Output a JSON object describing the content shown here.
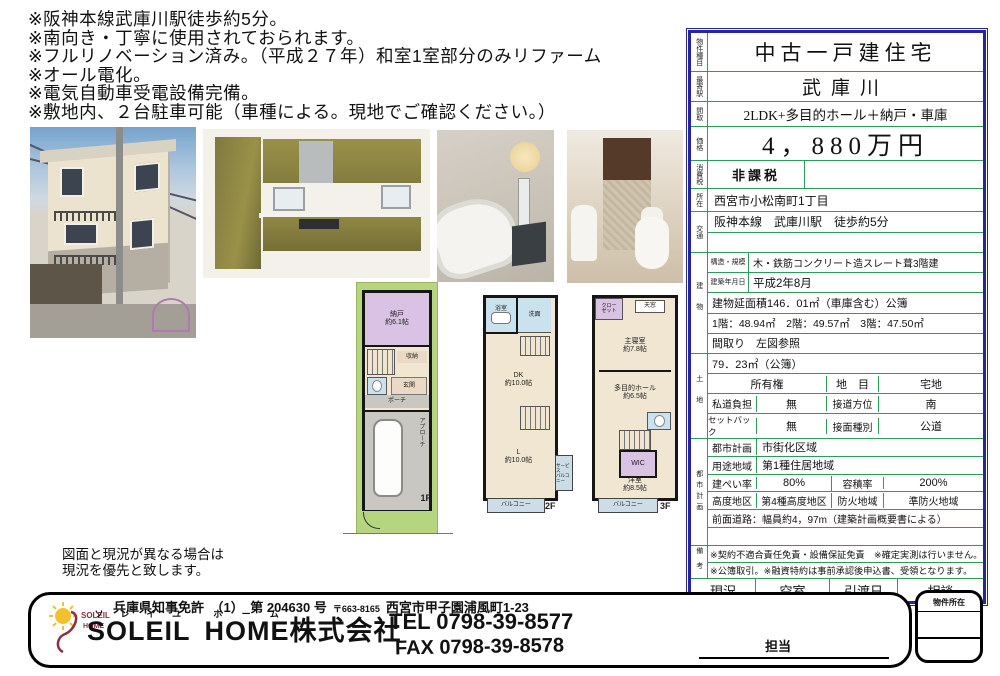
{
  "notes": {
    "lines": [
      "※阪神本線武庫川駅徒歩約5分。",
      "※南向き・丁寧に使用されておられます。",
      "※フルリノベーション済み。（平成２７年）和室1室部分のみリファーム",
      "※オール電化。",
      "※電気自動車受電設備完備。",
      "※敷地内、２台駐車可能（車種による。現地でご確認ください。）"
    ]
  },
  "disclaimer": {
    "line1": "図面と現況が異なる場合は",
    "line2": "現況を優先と致します。"
  },
  "table": {
    "property_type_label": "物件種目",
    "property_type": "中古一戸建住宅",
    "station_label": "最寄駅",
    "station": "武庫川",
    "layout_label": "間取",
    "layout": "2LDK+多目的ホール＋納戸・車庫",
    "price_label": "価格",
    "price": "4，880万円",
    "tax_label": "消費税",
    "tax": "非課税",
    "location_label": "所在",
    "location": "西宮市小松南町1丁目",
    "access_label": "交通",
    "access": "阪神本線　武庫川駅　徒歩約5分",
    "building": {
      "section_label": "建物",
      "structure_label": "構造・規模",
      "structure": "木・鉄筋コンクリート造スレート葺3階建",
      "built_label": "建築年月日",
      "built": "平成2年8月",
      "total_area": "建物延面積146．01㎡（車庫含む）公簿",
      "floor_areas": "1階：48.94㎡　2階：49.57㎡　3階：47.50㎡",
      "madori": "間取り　左図参照"
    },
    "land": {
      "section_label": "土地",
      "area": "79．23㎡（公簿）",
      "ownership": "所有権",
      "chimoku_label": "地　目",
      "chimoku": "宅地",
      "private_road_label": "私道負担",
      "private_road": "無",
      "direction_label": "接道方位",
      "direction": "南",
      "setback_label": "セットバック",
      "setback": "無",
      "road_type_label": "接面種別",
      "road_type": "公道"
    },
    "city": {
      "section_label": "都市計画",
      "plan_label": "都市計画",
      "plan": "市街化区域",
      "zoning_label": "用途地域",
      "zoning": "第1種住居地域",
      "coverage_label": "建ぺい率",
      "coverage": "80%",
      "far_label": "容積率",
      "far": "200%",
      "height_label": "高度地区",
      "height": "第4種高度地区",
      "fire_label": "防火地域",
      "fire": "準防火地域",
      "front_road": "前面道路：幅員約4，97m（建築計画概要書による）"
    },
    "remarks": {
      "section_label": "備考",
      "line1": "※契約不適合責任免責・設備保証免責　※確定実測は行いません。",
      "line2": "※公簿取引。※融資特約は事前承認後申込書、受領となります。"
    },
    "status_label": "現況",
    "status": "空室",
    "handover_label": "引渡日",
    "handover": "相談"
  },
  "floorplans": {
    "f1": {
      "nando1": "納戸",
      "nando2": "約6.1帖",
      "shuno": "収納",
      "genkan": "玄関",
      "porch": "ポーチ",
      "approach": "アプローチ",
      "floor": "1F"
    },
    "f2": {
      "bath": "浴室",
      "wash": "洗面",
      "dk1": "DK",
      "dk2": "約10.0帖",
      "l1": "L",
      "l2": "約10.0帖",
      "svc1": "サービス",
      "svc2": "バルコニー",
      "balcony": "バルコニー",
      "floor": "2F"
    },
    "f3": {
      "closet1": "クロー",
      "closet2": "ゼット",
      "tenmado": "天窓",
      "master1": "主寝室",
      "master2": "約7.8帖",
      "hall1": "多目的ホール",
      "hall2": "約6.5帖",
      "wic": "WIC",
      "yoshitsu1": "洋室",
      "yoshitsu2": "約8.5帖",
      "balcony": "バルコニー",
      "floor": "3F"
    }
  },
  "footer": {
    "license": "兵庫県知事免許　（1）　第 204630 号",
    "postal": "〒663-8165",
    "address": "西宮市甲子園浦風町1-23",
    "company_en1": "SOLEIL",
    "company_ruby1": "ソレイユ",
    "company_en2": "HOME",
    "company_ruby2": "ホーム",
    "company_suffix": "株式会社",
    "tel": "TEL 0798-39-8577",
    "fax": "FAX 0798-39-8578",
    "tanto": "担当",
    "logo_line1": "SOLEIL",
    "logo_line2": "HOME"
  },
  "side_box": {
    "title": "物件所在"
  },
  "colors": {
    "table_border": "#26269a",
    "table_grid": "#2e9a5c",
    "site_green": "#b5d67e",
    "room_cream": "#f0e6d2",
    "room_purple": "#d9c2e3",
    "room_blue": "#c9e2ee",
    "balcony_blue": "#ccdde8",
    "logo_red": "#8e2f3c",
    "logo_yellow": "#f2c12e"
  }
}
